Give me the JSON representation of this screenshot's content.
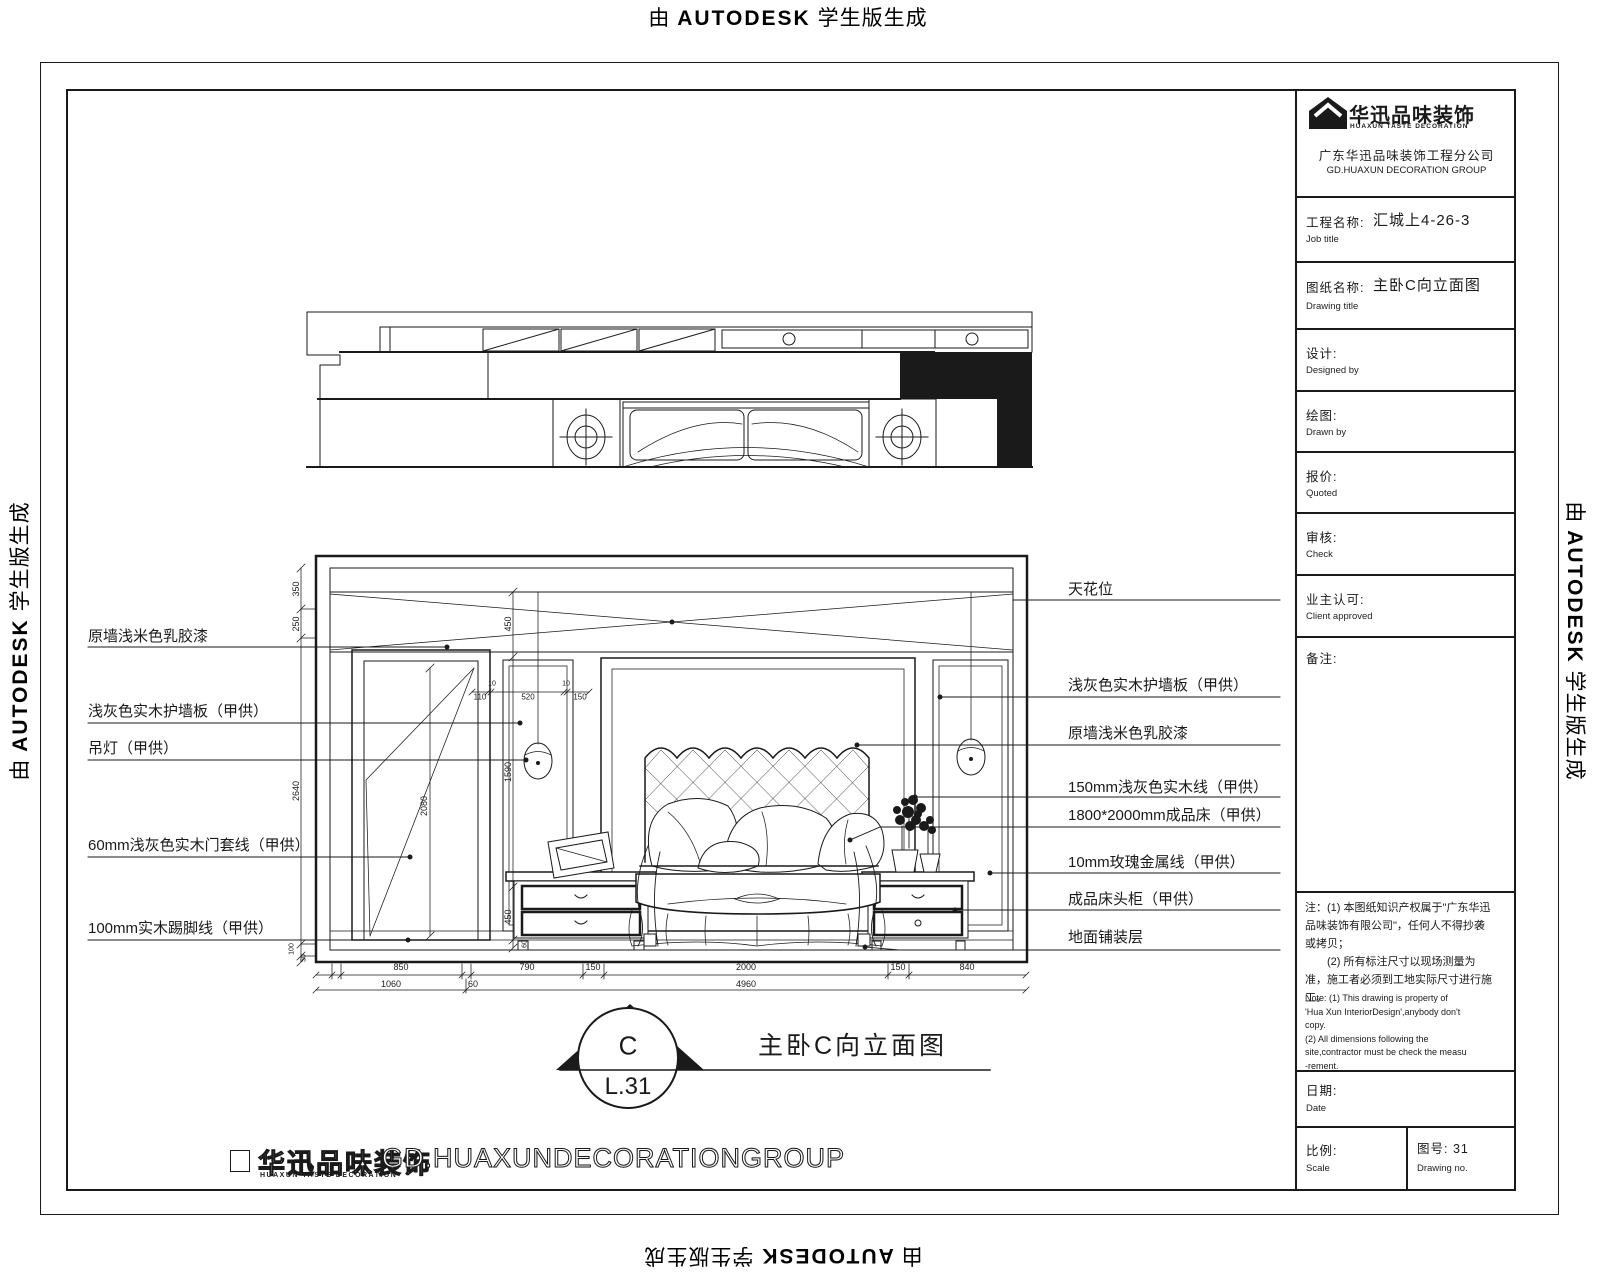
{
  "watermark": {
    "prefix": "由",
    "brand": "AUTODESK",
    "suffix": "学生版生成"
  },
  "titleblock": {
    "logo_cn": "华迅品味装饰",
    "logo_en": "HUAXUN TASTE DECORATION",
    "company_cn": "广东华迅品味装饰工程分公司",
    "company_en": "GD.HUAXUN DECORATION GROUP",
    "job_label": "工程名称:",
    "job_value": "汇城上4-26-3",
    "job_sub": "Job title",
    "dwg_label": "图纸名称:",
    "dwg_value": "主卧C向立面图",
    "dwg_sub": "Drawing title",
    "design_label": "设计:",
    "design_sub": "Designed by",
    "drawn_label": "绘图:",
    "drawn_sub": "Drawn by",
    "quote_label": "报价:",
    "quote_sub": "Quoted",
    "check_label": "审核:",
    "check_sub": "Check",
    "client_label": "业主认可:",
    "client_sub": "Client approved",
    "remark_label": "备注:",
    "note_cn": [
      "注：(1) 本图纸知识产权属于\"广东华迅",
      "品味装饰有限公司\"，任何人不得抄袭",
      "或拷贝；",
      "　　(2) 所有标注尺寸以现场测量为",
      "准，施工者必须到工地实际尺寸进行施工。"
    ],
    "note_en": [
      "Note: (1) This drawing is property of",
      "'Hua Xun InteriorDesign',anybody don't",
      "copy.",
      "    (2) All dimensions following the",
      "site,contractor must be check the measu",
      "-rement."
    ],
    "date_label": "日期:",
    "date_sub": "Date",
    "scale_label": "比例:",
    "scale_sub": "Scale",
    "no_label": "图号: 31",
    "no_sub": "Drawing no."
  },
  "labels": {
    "left": [
      "原墙浅米色乳胶漆",
      "浅灰色实木护墙板（甲供）",
      "吊灯（甲供）",
      "60mm浅灰色实木门套线（甲供）",
      "100mm实木踢脚线（甲供）"
    ],
    "right": [
      "天花位",
      "浅灰色实木护墙板（甲供）",
      "原墙浅米色乳胶漆",
      "150mm浅灰色实木线（甲供）",
      "1800*2000mm成品床（甲供）",
      "10mm玫瑰金属线（甲供）",
      "成品床头柜（甲供）",
      "地面铺装层"
    ]
  },
  "dims": {
    "left": [
      "350",
      "250",
      "2640",
      "100",
      "50"
    ],
    "bottom": [
      "850",
      "790",
      "150",
      "2000",
      "150",
      "840"
    ],
    "bottom_totals": [
      "1060",
      "60",
      "4960"
    ],
    "inner": [
      "450",
      "1590",
      "450",
      "60",
      "110",
      "10",
      "520",
      "10",
      "150",
      "2080"
    ]
  },
  "marker": {
    "letter": "C",
    "code": "L.31",
    "title": "主卧C向立面图"
  },
  "footer": {
    "logo_cn": "华迅品味装饰",
    "logo_en": "HUAXUN TASTE DECORATION",
    "text": "GD.HUAXUNDECORATIONGROUP"
  }
}
